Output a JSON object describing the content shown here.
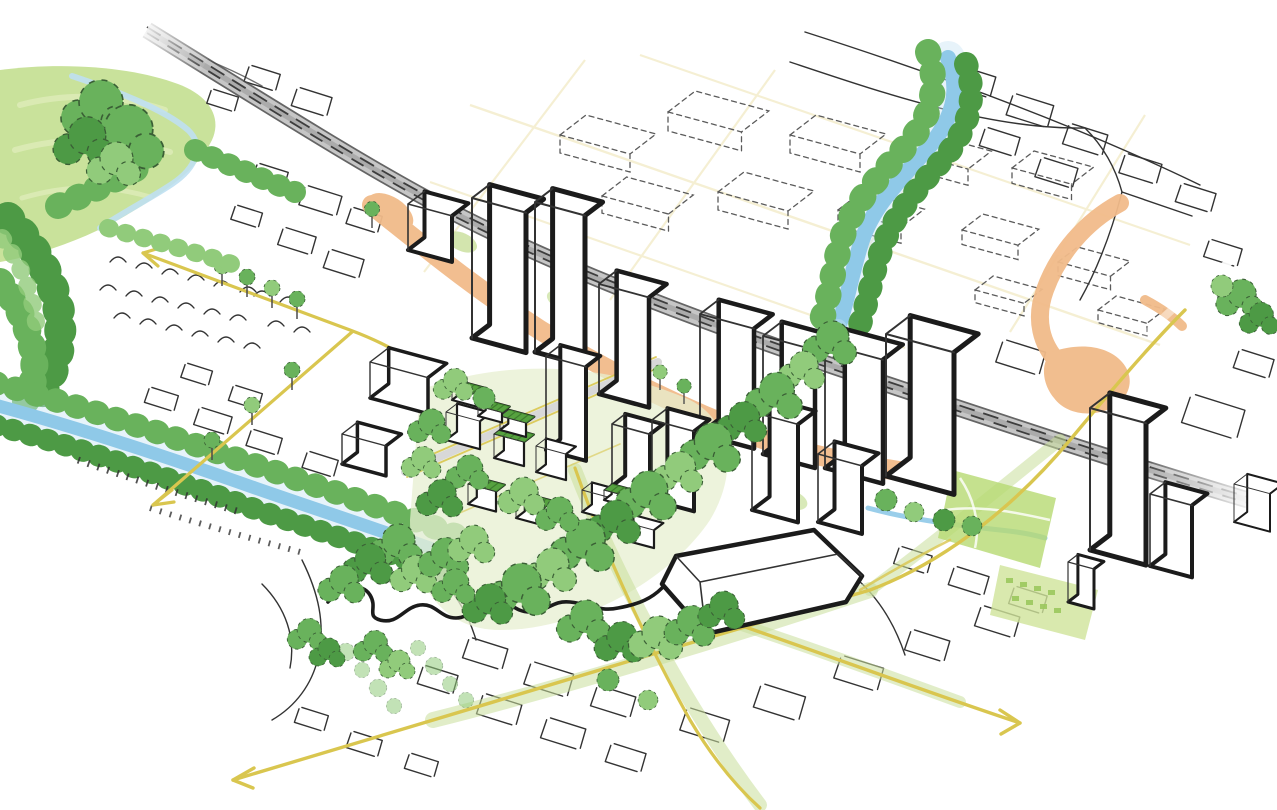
{
  "scene": {
    "kind": "urban-masterplan-axonometric-watercolor-sketch",
    "text_content": [],
    "legend_elements": [
      "hillside-park",
      "railway-corridor",
      "station-plaza-orange-zones",
      "meandering-river-corridor",
      "left-canal-with-tree-banks",
      "central-green-neighborhood",
      "green-roof-blocks",
      "proposed-white-towers",
      "existing-sketched-blocks",
      "background-dashed-city-grid",
      "yellow-road-axes-with-arrows",
      "lawn-washes",
      "street-tree-rows"
    ],
    "arrow_directions": [
      "upper-left",
      "lower-left",
      "bottom-left",
      "lower-right"
    ]
  },
  "colors": {
    "paper": "#ffffff",
    "park_wash": "#c9e29b",
    "park_wash_light": "#dcebb6",
    "lawn_pale": "#e7efd0",
    "boulevard_wash": "#c8df9a",
    "station_lawn": "#b7da72",
    "tree_green": "#69b25c",
    "tree_green_light": "#91cb7b",
    "tree_green_dark": "#4d9a45",
    "river_blue": "#8fc9e8",
    "river_wash": "#c9e5f5",
    "railway_gray": "#c6c6c6",
    "railway_rail": "#3d3d3d",
    "road_yellow": "#d9c64f",
    "road_yellow_faint": "#e9dd9f",
    "plaza_orange": "#f1bb8a",
    "street_gray": "#d8d8d8",
    "building_white": "#ffffff",
    "ink_heavy": "#1b1b1b",
    "ink": "#333333",
    "ink_dashed": "#5b5b5b",
    "green_roof": "#56a23f",
    "green_roof_dark": "#3e7d2e"
  }
}
